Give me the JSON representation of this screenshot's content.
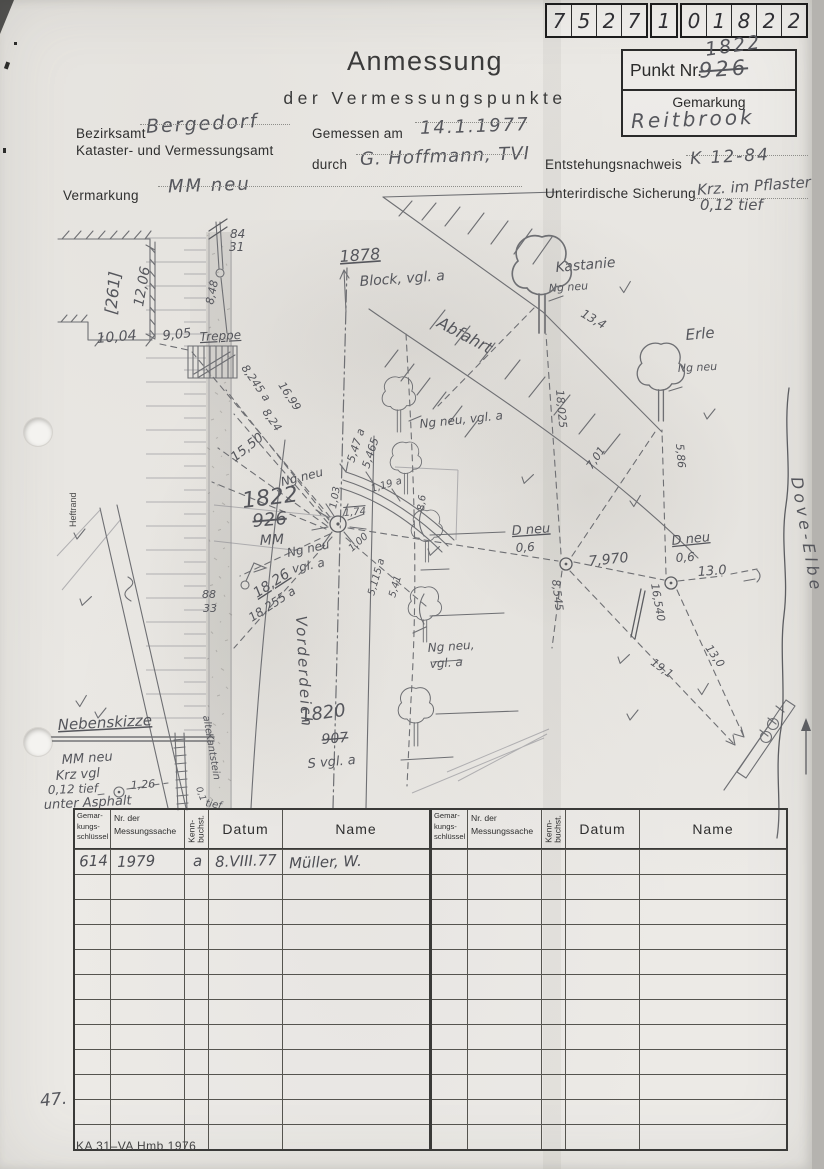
{
  "paper": {
    "serial_groups": [
      [
        "7",
        "5",
        "2",
        "7"
      ],
      [
        "1"
      ],
      [
        "0",
        "1",
        "8",
        "2",
        "2"
      ]
    ],
    "title": {
      "line1": "Anmessung",
      "line2": "der Vermessungspunkte"
    },
    "punkt": {
      "label": "Punkt Nr.",
      "old_value": "926",
      "new_value": "1822",
      "gemarkung_label": "Gemarkung",
      "gemarkung_value": "Reitbrook"
    },
    "fields": {
      "bezirksamt_label": "Bezirksamt",
      "bezirksamt_value": "Bergedorf",
      "amt_line": "Kataster- und Vermessungsamt",
      "gemessen_label": "Gemessen am",
      "gemessen_value": "14.1.1977",
      "durch_label": "durch",
      "durch_value": "G. Hoffmann, TVI",
      "entstehung_label": "Entstehungsnachweis",
      "entstehung_value": "K 12-84",
      "vermarkung_label": "Vermarkung",
      "vermarkung_value": "MM neu",
      "sicherung_label": "Unterirdische Sicherung",
      "sicherung_value_line1": "Krz. im Pflaster",
      "sicherung_value_line2": "0,12 tief"
    },
    "footer": {
      "page_note": "47.",
      "form_code": "KA 31–VA Hmb 1976"
    }
  },
  "sketch": {
    "labels": [
      {
        "t": "[261]",
        "x": 116,
        "y": 315,
        "r": -84,
        "s": 16
      },
      {
        "t": "12,06",
        "x": 143,
        "y": 307,
        "r": -80,
        "s": 14
      },
      {
        "t": "10,04",
        "x": 97,
        "y": 343,
        "r": -5,
        "s": 14
      },
      {
        "t": "84",
        "x": 230,
        "y": 238,
        "s": 12
      },
      {
        "t": "31",
        "x": 229,
        "y": 251,
        "s": 12
      },
      {
        "t": "8,48",
        "x": 213,
        "y": 305,
        "r": -78,
        "s": 11
      },
      {
        "t": "9,05",
        "x": 163,
        "y": 340,
        "r": -6,
        "s": 13
      },
      {
        "t": "Treppe",
        "x": 200,
        "y": 341,
        "r": -3,
        "s": 12,
        "dec": "underline"
      },
      {
        "t": "16,99",
        "x": 278,
        "y": 385,
        "r": 57,
        "s": 11
      },
      {
        "t": "8,245 a",
        "x": 241,
        "y": 368,
        "r": 55,
        "s": 11
      },
      {
        "t": "8,24",
        "x": 262,
        "y": 412,
        "r": 55,
        "s": 11
      },
      {
        "t": "15,50",
        "x": 235,
        "y": 462,
        "r": -38,
        "s": 13
      },
      {
        "t": "1878",
        "x": 340,
        "y": 262,
        "r": -4,
        "s": 16,
        "dec": "underline"
      },
      {
        "t": "Block, vgl. a",
        "x": 360,
        "y": 286,
        "r": -4,
        "s": 14
      },
      {
        "t": "Abfahrt",
        "x": 436,
        "y": 326,
        "r": 28,
        "s": 16
      },
      {
        "t": "Kastanie",
        "x": 556,
        "y": 272,
        "r": -5,
        "s": 14
      },
      {
        "t": "Ng neu",
        "x": 549,
        "y": 292,
        "r": -4,
        "s": 11
      },
      {
        "t": "13,4",
        "x": 580,
        "y": 316,
        "r": 30,
        "s": 12
      },
      {
        "t": "Erle",
        "x": 686,
        "y": 340,
        "r": -5,
        "s": 15
      },
      {
        "t": "Ng neu",
        "x": 678,
        "y": 372,
        "r": -3,
        "s": 11
      },
      {
        "t": "18,025",
        "x": 556,
        "y": 390,
        "r": 85,
        "s": 11
      },
      {
        "t": "7,01",
        "x": 592,
        "y": 470,
        "r": -56,
        "s": 11
      },
      {
        "t": "5,86",
        "x": 676,
        "y": 444,
        "r": 85,
        "s": 11
      },
      {
        "t": "Ng neu, vgl. a",
        "x": 420,
        "y": 428,
        "r": -6,
        "s": 12
      },
      {
        "t": "5,47 a",
        "x": 354,
        "y": 463,
        "r": -72,
        "s": 11
      },
      {
        "t": "5,465",
        "x": 369,
        "y": 469,
        "r": -72,
        "s": 11
      },
      {
        "t": "1,03",
        "x": 336,
        "y": 509,
        "r": -80,
        "s": 10
      },
      {
        "t": "1,19 a",
        "x": 372,
        "y": 492,
        "r": -16,
        "s": 10
      },
      {
        "t": "8,6",
        "x": 424,
        "y": 511,
        "r": -84,
        "s": 10
      },
      {
        "t": "1,74",
        "x": 344,
        "y": 516,
        "r": -5,
        "s": 10,
        "dec": "overline"
      },
      {
        "t": "1,00",
        "x": 352,
        "y": 552,
        "r": -42,
        "s": 10
      },
      {
        "t": "5,115 a",
        "x": 374,
        "y": 596,
        "r": -74,
        "s": 10
      },
      {
        "t": "5,41",
        "x": 395,
        "y": 598,
        "r": -74,
        "s": 10
      },
      {
        "t": "Ng neu",
        "x": 282,
        "y": 486,
        "r": -14,
        "s": 12
      },
      {
        "t": "1822",
        "x": 243,
        "y": 508,
        "r": -7,
        "s": 22
      },
      {
        "t": "926",
        "x": 253,
        "y": 527,
        "r": -5,
        "s": 18,
        "dec": "line-through"
      },
      {
        "t": "MM",
        "x": 260,
        "y": 545,
        "r": -3,
        "s": 14
      },
      {
        "t": "Ng neu",
        "x": 288,
        "y": 557,
        "r": -12,
        "s": 12
      },
      {
        "t": "vgl. a",
        "x": 293,
        "y": 573,
        "r": -12,
        "s": 12
      },
      {
        "t": "18,26",
        "x": 257,
        "y": 598,
        "r": -33,
        "s": 14,
        "dec": "underline"
      },
      {
        "t": "18,255 a",
        "x": 252,
        "y": 622,
        "r": -33,
        "s": 12
      },
      {
        "t": "88",
        "x": 202,
        "y": 598,
        "s": 11
      },
      {
        "t": "33",
        "x": 203,
        "y": 612,
        "s": 11
      },
      {
        "t": "D neu",
        "x": 512,
        "y": 535,
        "r": -4,
        "s": 13,
        "dec": "underline"
      },
      {
        "t": "0,6",
        "x": 516,
        "y": 552,
        "r": -4,
        "s": 12
      },
      {
        "t": "8,545",
        "x": 552,
        "y": 580,
        "r": 83,
        "s": 11
      },
      {
        "t": "7,970",
        "x": 589,
        "y": 566,
        "r": -6,
        "s": 14
      },
      {
        "t": "D neu",
        "x": 672,
        "y": 545,
        "r": -6,
        "s": 13,
        "dec": "underline"
      },
      {
        "t": "0,6",
        "x": 676,
        "y": 562,
        "r": -4,
        "s": 12
      },
      {
        "t": "13.0",
        "x": 698,
        "y": 576,
        "r": -4,
        "s": 13
      },
      {
        "t": "16,540",
        "x": 651,
        "y": 584,
        "r": 80,
        "s": 11
      },
      {
        "t": "19,1",
        "x": 650,
        "y": 664,
        "r": 36,
        "s": 11
      },
      {
        "t": "13,0",
        "x": 705,
        "y": 648,
        "r": 55,
        "s": 11
      },
      {
        "t": "Dove-Elbe",
        "x": 791,
        "y": 478,
        "r": 80,
        "s": 16,
        "ls": 4
      },
      {
        "t": "Vorderdeich",
        "x": 296,
        "y": 616,
        "r": 87,
        "s": 15,
        "ls": 2
      },
      {
        "t": "Heftrand",
        "x": 76,
        "y": 527,
        "r": -90,
        "s": 9,
        "cls": "print"
      },
      {
        "t": "1820",
        "x": 301,
        "y": 722,
        "r": -8,
        "s": 18
      },
      {
        "t": "907",
        "x": 322,
        "y": 744,
        "r": -5,
        "s": 14,
        "dec": "line-through"
      },
      {
        "t": "S vgl. a",
        "x": 308,
        "y": 768,
        "r": -5,
        "s": 13
      },
      {
        "t": "Ng neu,",
        "x": 428,
        "y": 652,
        "r": -4,
        "s": 12
      },
      {
        "t": "vgl. a",
        "x": 430,
        "y": 668,
        "r": -4,
        "s": 12
      },
      {
        "t": "Nebenskizze",
        "x": 58,
        "y": 730,
        "r": -3,
        "s": 15,
        "dec": "underline"
      },
      {
        "t": "MM neu",
        "x": 62,
        "y": 764,
        "r": -4,
        "s": 13
      },
      {
        "t": "Krz vgl",
        "x": 56,
        "y": 780,
        "r": -4,
        "s": 13
      },
      {
        "t": "0,12 tief",
        "x": 48,
        "y": 794,
        "r": -2,
        "s": 12
      },
      {
        "t": "unter Asphalt",
        "x": 44,
        "y": 809,
        "r": -3,
        "s": 13
      },
      {
        "t": "1,26",
        "x": 131,
        "y": 789,
        "r": -4,
        "s": 11
      },
      {
        "t": "alte",
        "x": 203,
        "y": 716,
        "r": 80,
        "s": 10
      },
      {
        "t": "Kantstein",
        "x": 206,
        "y": 734,
        "r": 80,
        "s": 10
      },
      {
        "t": "0,1",
        "x": 196,
        "y": 788,
        "r": 70,
        "s": 9
      },
      {
        "t": "tief",
        "x": 205,
        "y": 806,
        "r": 10,
        "s": 10
      }
    ],
    "vi_marks": [
      [
        620,
        287
      ],
      [
        704,
        413
      ],
      [
        522,
        477
      ],
      [
        630,
        501
      ],
      [
        74,
        533
      ],
      [
        80,
        599
      ],
      [
        76,
        701
      ],
      [
        95,
        712
      ],
      [
        618,
        657
      ],
      [
        698,
        689
      ],
      [
        627,
        714
      ],
      [
        428,
        549
      ]
    ],
    "trees": [
      {
        "x": 542,
        "y": 333,
        "s": 1.5
      },
      {
        "x": 661,
        "y": 421,
        "s": 1.2
      },
      {
        "x": 399,
        "y": 432,
        "s": 0.85
      },
      {
        "x": 406,
        "y": 494,
        "s": 0.8
      },
      {
        "x": 427,
        "y": 562,
        "s": 0.8
      },
      {
        "x": 425,
        "y": 642,
        "s": 0.85
      },
      {
        "x": 416,
        "y": 746,
        "s": 0.9
      }
    ]
  },
  "table": {
    "header": {
      "col1_lines": [
        "Gemar-",
        "kungs-",
        "schlüssel"
      ],
      "col2_lines": [
        "Nr. der",
        "Messungssache"
      ],
      "col3_lines": [
        "Kenn-",
        "buchst."
      ],
      "col4": "Datum",
      "col5": "Name"
    },
    "col_widths": [
      36,
      74,
      24,
      74,
      146
    ],
    "row_count": 12,
    "left_rows": [
      [
        "614",
        "1979",
        "a",
        "8.VIII.77",
        "Müller, W."
      ]
    ],
    "right_rows": []
  }
}
